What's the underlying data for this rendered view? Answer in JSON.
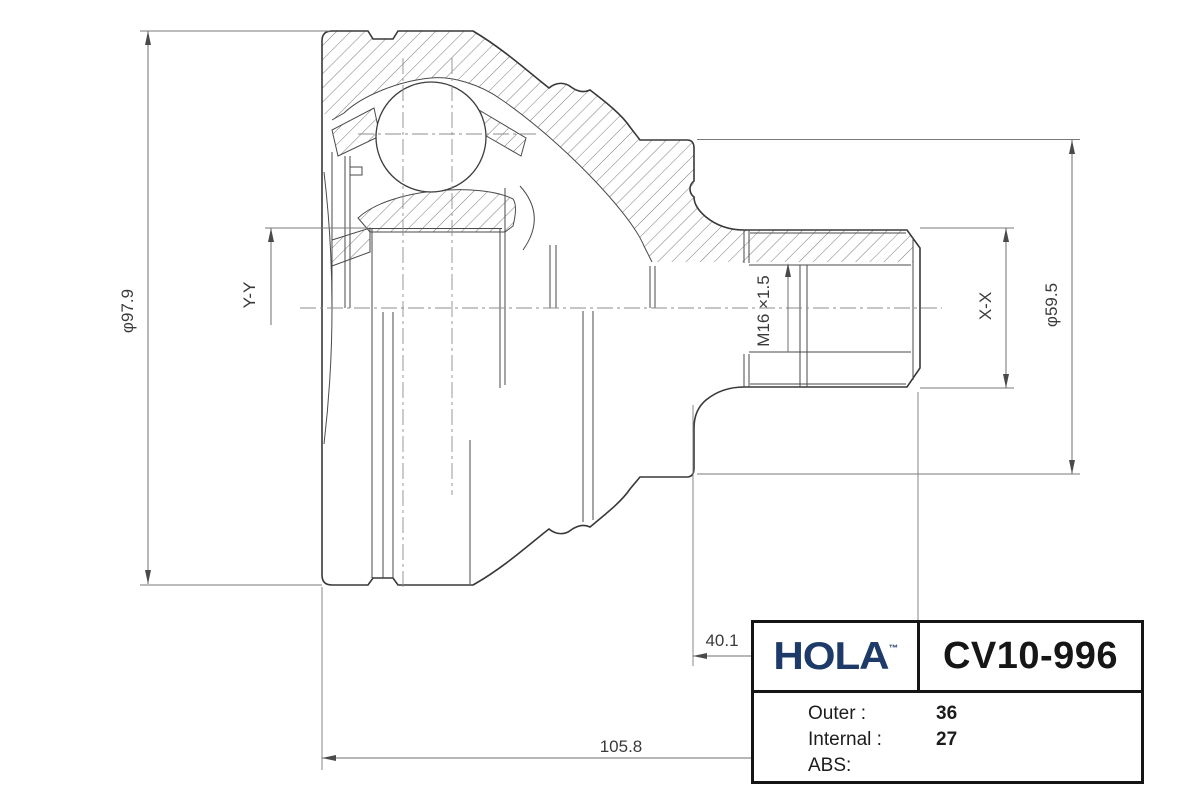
{
  "drawing": {
    "type": "technical-section-drawing",
    "subject": "CV joint outer race with stub shaft, half-section view",
    "dimensions": {
      "outer_diameter": "φ97.9",
      "section_left": "Y-Y",
      "thread": "M16 ×1.5",
      "section_right": "X-X",
      "flange_diameter": "φ59.5",
      "thread_length": "40.1",
      "overall_length": "105.8"
    },
    "line_color": "#3a3a3a",
    "hatch_color": "#6b6b6b"
  },
  "title_block": {
    "brand": "HOLA",
    "trademark": "TM",
    "part_number": "CV10-996",
    "brand_color": "#1d3a69",
    "specs": [
      {
        "label": "Outer :",
        "value": "36"
      },
      {
        "label": "Internal :",
        "value": "27"
      },
      {
        "label": "ABS:",
        "value": ""
      }
    ]
  }
}
